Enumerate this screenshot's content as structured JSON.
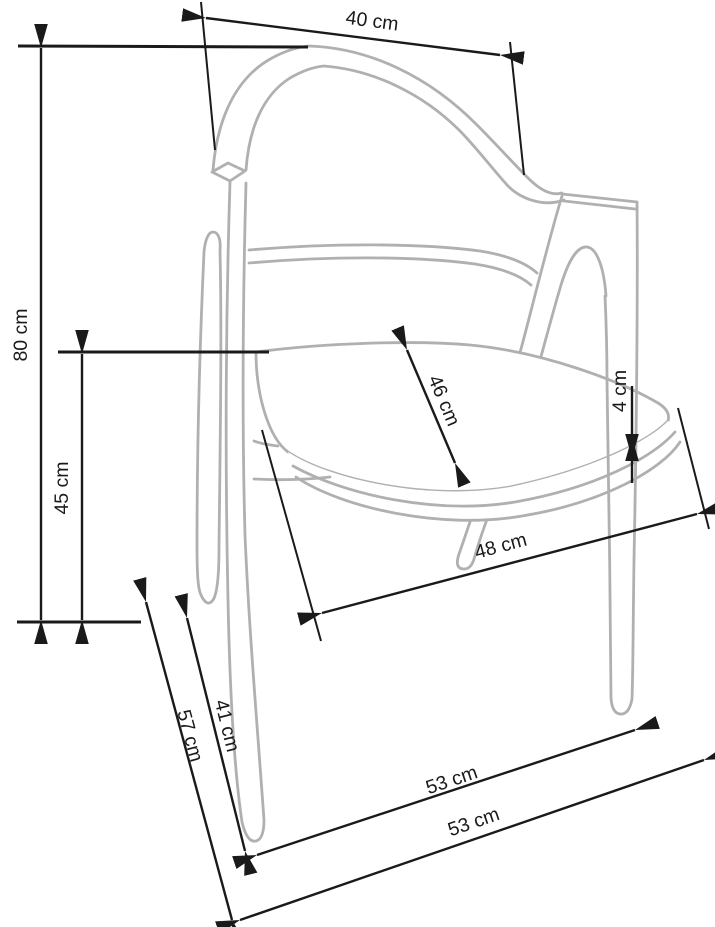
{
  "diagram": {
    "type": "furniture-dimension-drawing",
    "subject": "armchair side-perspective outline with dimension arrows",
    "colors": {
      "outline": "#b0b0b0",
      "dimension": "#1a1a1a",
      "background": "#ffffff"
    },
    "labels": {
      "backrest_width": "40 cm",
      "total_height": "80 cm",
      "seat_height": "45 cm",
      "seat_depth": "46 cm",
      "seat_thickness": "4 cm",
      "seat_width": "48 cm",
      "leg_span_inner": "41 cm",
      "leg_span_outer": "57 cm",
      "base_span_upper": "53 cm",
      "base_span_lower": "53 cm"
    }
  }
}
